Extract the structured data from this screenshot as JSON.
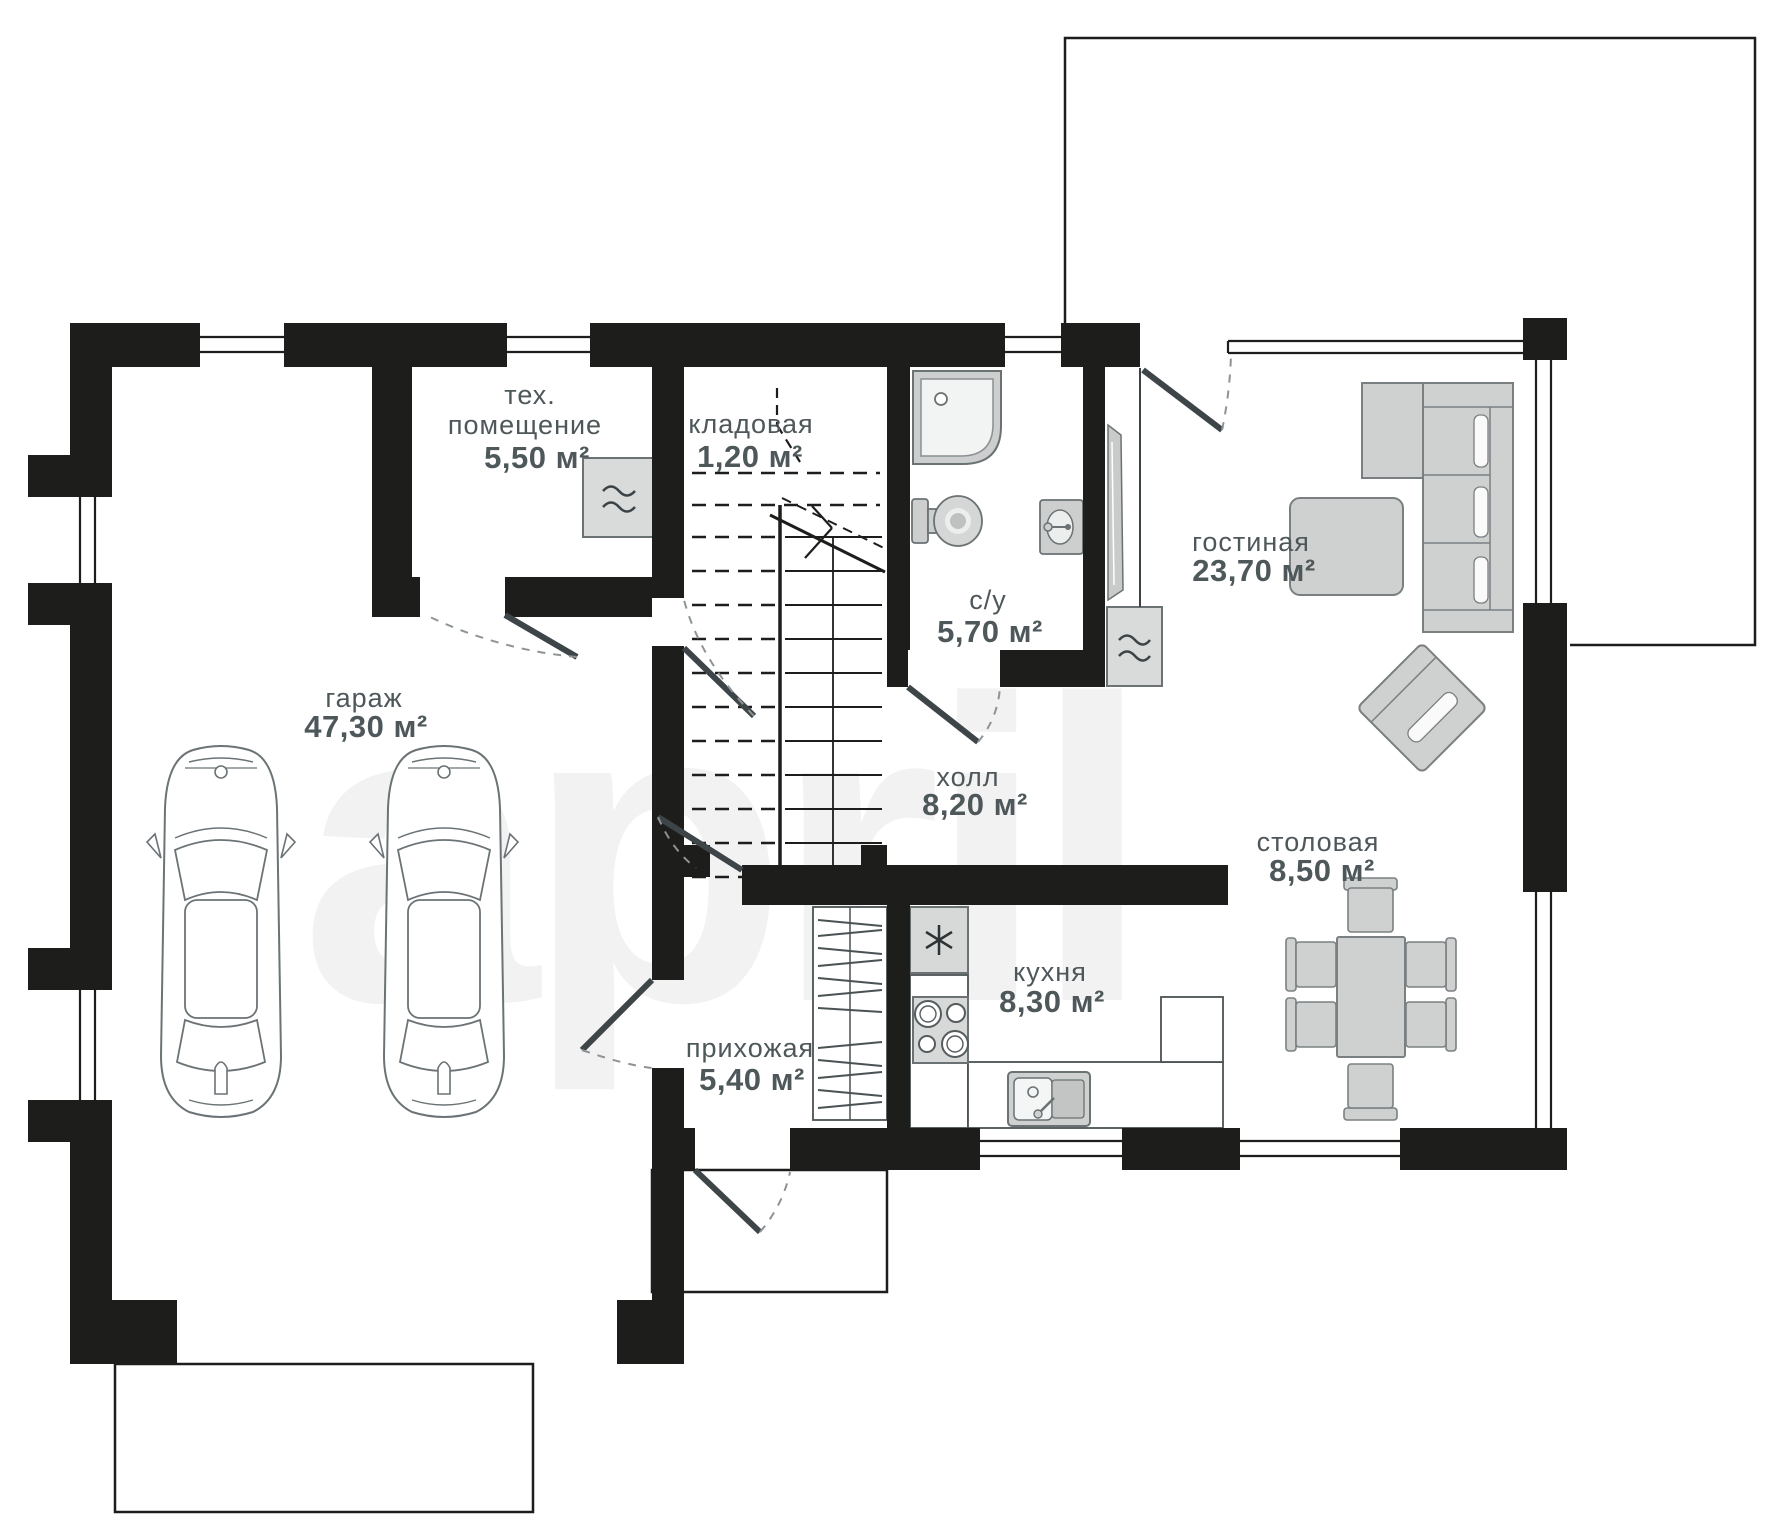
{
  "watermark": "april",
  "colors": {
    "wall": "#1d1d1b",
    "label": "#4e575a",
    "furniture_fill": "#d2d3d3",
    "furniture_stroke": "#6b7376",
    "watermark": "#f2f2f2",
    "door": "#3d4548"
  },
  "rooms": [
    {
      "id": "garage",
      "name": "гараж",
      "area": "47,30 м²"
    },
    {
      "id": "tech",
      "name_lines": [
        "тех.",
        "помещение"
      ],
      "area": "5,50 м²"
    },
    {
      "id": "storage",
      "name": "кладовая",
      "area": "1,20 м²"
    },
    {
      "id": "bathroom",
      "name": "с/у",
      "area": "5,70 м²"
    },
    {
      "id": "hall",
      "name": "холл",
      "area": "8,20 м²"
    },
    {
      "id": "living",
      "name": "гостиная",
      "area": "23,70 м²"
    },
    {
      "id": "dining",
      "name": "столовая",
      "area": "8,50 м²"
    },
    {
      "id": "kitchen",
      "name": "кухня",
      "area": "8,30 м²"
    },
    {
      "id": "entry",
      "name": "прихожая",
      "area": "5,40 м²"
    }
  ],
  "fixtures": [
    "car",
    "car",
    "boiler",
    "boiler",
    "shower",
    "toilet",
    "wash-basin",
    "mirror-panel",
    "sofa",
    "coffee-table",
    "armchair",
    "dining-table",
    "fridge",
    "stove",
    "kitchen-sink",
    "wardrobe",
    "stairs"
  ]
}
